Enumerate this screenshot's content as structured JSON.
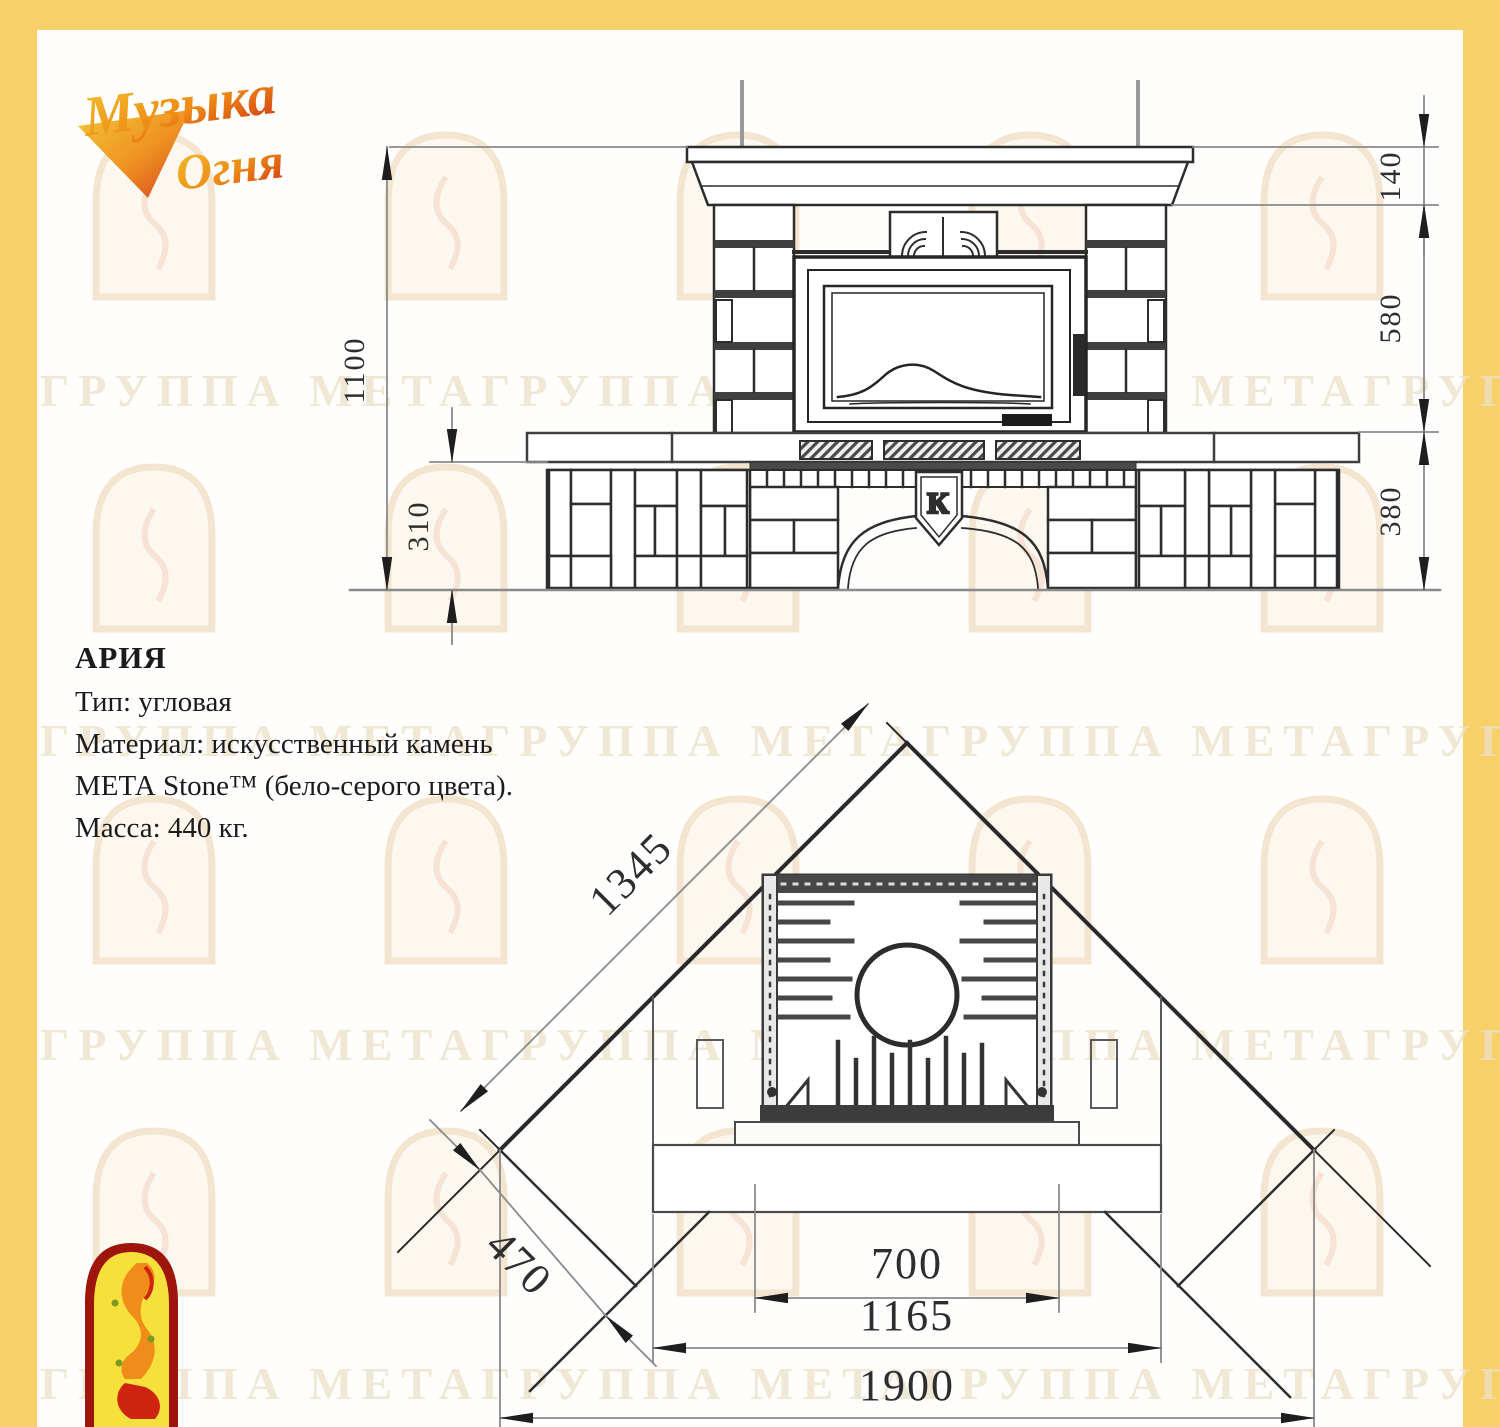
{
  "logo": {
    "line1": "Музыка",
    "line2": "Огня"
  },
  "product": {
    "name": "АРИЯ",
    "lines": [
      "Тип: угловая",
      "Материал: искусственный камень",
      "МЕТА Stone™ (бело-серого цвета).",
      "Масса: 440 кг."
    ]
  },
  "front_view": {
    "dims": {
      "height_total": "1100",
      "hearth_height": "310",
      "mantel_height": "140",
      "middle_height": "580",
      "base_height": "380"
    },
    "keystone": "К"
  },
  "plan_view": {
    "dims": {
      "side_wall": "1345",
      "corner_depth": "470",
      "firebox_width": "700",
      "body_width": "1165",
      "overall_width": "1900"
    }
  },
  "watermark": {
    "row": "ГРУППА МЕТАГРУППА МЕТАГРУППА МЕТАГРУППА МЕТА"
  },
  "colors": {
    "border": "#f8d06a",
    "line": "#2d2d2d",
    "ext_line": "#a5a5a5",
    "watermark": "#f3e5cf"
  }
}
